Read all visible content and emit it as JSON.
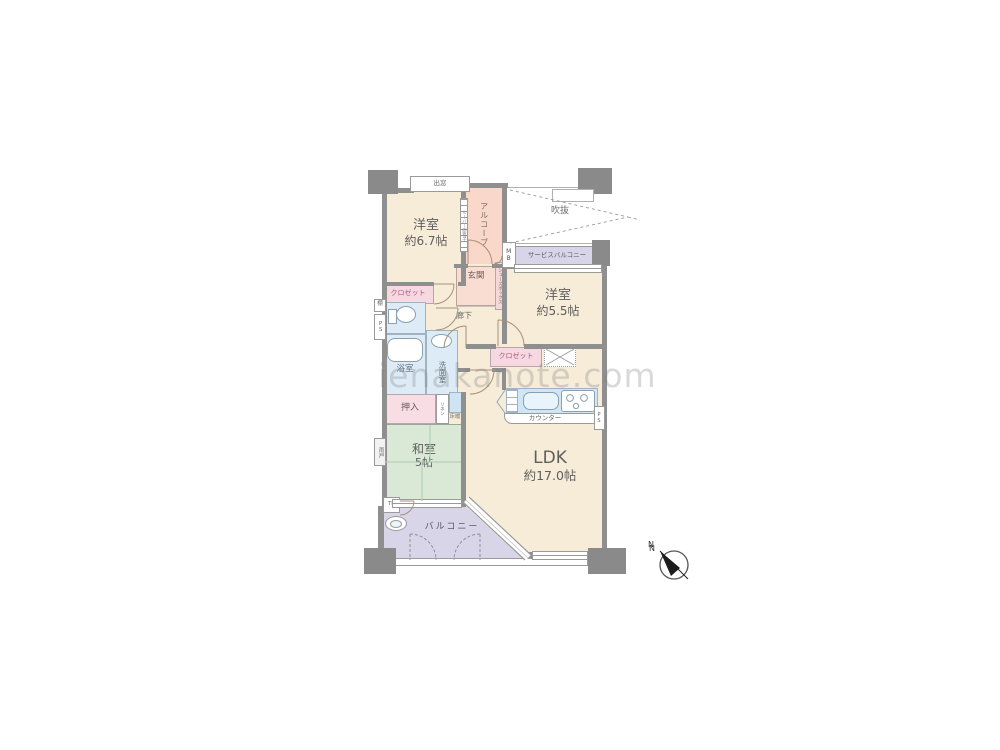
{
  "watermark": "ienakanote.com",
  "plan": {
    "rooms": {
      "western_6_7": {
        "name": "洋室",
        "size": "約6.7帖"
      },
      "western_5_5": {
        "name": "洋室",
        "size": "約5.5帖"
      },
      "japanese_5": {
        "name": "和室",
        "size": "5帖"
      },
      "ldk": {
        "name": "LDK",
        "size": "約17.0帖"
      }
    },
    "labels": {
      "bay_window": "出窓",
      "alcove": "アルコーブ",
      "void": "吹抜",
      "service_balcony": "サービスバルコニー",
      "meter_box": "MB",
      "entrance": "玄関",
      "shoe_box": "シューズボックス",
      "hallway": "廊下",
      "closet_west": "クロゼット",
      "closet_east": "クロゼット",
      "shelf": "棚",
      "pipe_space_left": "PS",
      "pipe_space_kitchen": "PS",
      "bathroom": "浴室",
      "washroom": "洗面室",
      "futon_closet": "押入",
      "linen": "リネン",
      "floor_heating": "床暖",
      "storm_shutter": "雨戸",
      "louver_grate": "ルーバー面格子",
      "counter": "カウンター",
      "balcony": "バルコニー",
      "trunk_room": "TR",
      "north": "N"
    },
    "colors": {
      "wall": "#8f8f8f",
      "room_beige": "#f6ecd8",
      "tatami_green": "#d9e9d6",
      "wet_blue": "#dcebf6",
      "closet_pink": "#f6d8e0",
      "entry_salmon": "#f9d8ca",
      "balcony_lavender": "#d8d5e9",
      "closet_text": "#b05080"
    }
  }
}
